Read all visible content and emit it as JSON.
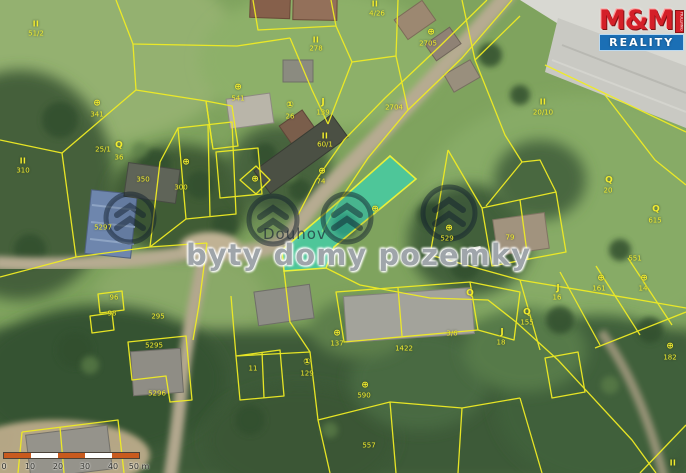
{
  "map": {
    "village_name": "Douhov",
    "watermark": "byty domy pozemky",
    "logo": {
      "mm": "M&M",
      "side": "HOLDING",
      "reality": "REALITY"
    },
    "colors": {
      "parcel_line": "#f0ec24",
      "highlight_fill": "rgba(38,228,202,0.55)",
      "highlight_stroke": "#e9f03a",
      "logo_red": "#d42028",
      "logo_blue": "#1b6fb5",
      "scale_orange": "#c85a1e",
      "scale_white": "#ffffff"
    },
    "scale_bar": {
      "segment_colors": [
        "#c85a1e",
        "#ffffff",
        "#c85a1e",
        "#ffffff",
        "#c85a1e"
      ],
      "labels": [
        {
          "x": 1,
          "t": "0"
        },
        {
          "x": 27,
          "t": "10"
        },
        {
          "x": 55,
          "t": "20"
        },
        {
          "x": 82,
          "t": "30"
        },
        {
          "x": 110,
          "t": "40"
        },
        {
          "x": 136,
          "t": "50 m"
        }
      ]
    },
    "parcel_labels": [
      {
        "x": 36,
        "y": 24,
        "t": "II",
        "k": "roman"
      },
      {
        "x": 36,
        "y": 34,
        "t": "51/2",
        "k": "num"
      },
      {
        "x": 97,
        "y": 104,
        "t": "⊕",
        "k": "sym"
      },
      {
        "x": 97,
        "y": 115,
        "t": "341",
        "k": "num"
      },
      {
        "x": 23,
        "y": 161,
        "t": "II",
        "k": "roman"
      },
      {
        "x": 23,
        "y": 171,
        "t": "310",
        "k": "num"
      },
      {
        "x": 103,
        "y": 150,
        "t": "25/1",
        "k": "num"
      },
      {
        "x": 119,
        "y": 146,
        "t": "Q",
        "k": "sym"
      },
      {
        "x": 119,
        "y": 158,
        "t": "36",
        "k": "num"
      },
      {
        "x": 143,
        "y": 180,
        "t": "350",
        "k": "num"
      },
      {
        "x": 181,
        "y": 188,
        "t": "300",
        "k": "num"
      },
      {
        "x": 186,
        "y": 163,
        "t": "⊕",
        "k": "sym"
      },
      {
        "x": 103,
        "y": 228,
        "t": "5297",
        "k": "num"
      },
      {
        "x": 158,
        "y": 317,
        "t": "295",
        "k": "num"
      },
      {
        "x": 154,
        "y": 346,
        "t": "5295",
        "k": "num"
      },
      {
        "x": 157,
        "y": 394,
        "t": "5296",
        "k": "num"
      },
      {
        "x": 114,
        "y": 298,
        "t": "96",
        "k": "num"
      },
      {
        "x": 112,
        "y": 314,
        "t": "98",
        "k": "num"
      },
      {
        "x": 316,
        "y": 40,
        "t": "II",
        "k": "roman"
      },
      {
        "x": 316,
        "y": 49,
        "t": "278",
        "k": "num"
      },
      {
        "x": 375,
        "y": 4,
        "t": "II",
        "k": "roman"
      },
      {
        "x": 377,
        "y": 14,
        "t": "4/26",
        "k": "num"
      },
      {
        "x": 238,
        "y": 88,
        "t": "⊕",
        "k": "sym"
      },
      {
        "x": 238,
        "y": 99,
        "t": "541",
        "k": "num"
      },
      {
        "x": 290,
        "y": 106,
        "t": "①",
        "k": "sym"
      },
      {
        "x": 290,
        "y": 117,
        "t": "26",
        "k": "num"
      },
      {
        "x": 323,
        "y": 103,
        "t": "J",
        "k": "sym"
      },
      {
        "x": 323,
        "y": 113,
        "t": "139",
        "k": "num"
      },
      {
        "x": 325,
        "y": 136,
        "t": "II",
        "k": "roman"
      },
      {
        "x": 325,
        "y": 145,
        "t": "60/1",
        "k": "num"
      },
      {
        "x": 394,
        "y": 108,
        "t": "2704",
        "k": "num"
      },
      {
        "x": 431,
        "y": 33,
        "t": "⊕",
        "k": "sym"
      },
      {
        "x": 428,
        "y": 44,
        "t": "2705",
        "k": "num"
      },
      {
        "x": 543,
        "y": 102,
        "t": "II",
        "k": "roman"
      },
      {
        "x": 543,
        "y": 113,
        "t": "20/10",
        "k": "num"
      },
      {
        "x": 322,
        "y": 172,
        "t": "⊕",
        "k": "sym"
      },
      {
        "x": 321,
        "y": 182,
        "t": "74",
        "k": "num"
      },
      {
        "x": 375,
        "y": 210,
        "t": "⊕",
        "k": "sym"
      },
      {
        "x": 449,
        "y": 229,
        "t": "⊕",
        "k": "sym"
      },
      {
        "x": 447,
        "y": 239,
        "t": "529",
        "k": "num"
      },
      {
        "x": 510,
        "y": 238,
        "t": "79",
        "k": "num"
      },
      {
        "x": 609,
        "y": 181,
        "t": "Q",
        "k": "sym"
      },
      {
        "x": 608,
        "y": 191,
        "t": "20",
        "k": "num"
      },
      {
        "x": 656,
        "y": 210,
        "t": "Q",
        "k": "sym"
      },
      {
        "x": 655,
        "y": 221,
        "t": "615",
        "k": "num"
      },
      {
        "x": 635,
        "y": 259,
        "t": "551",
        "k": "num"
      },
      {
        "x": 601,
        "y": 279,
        "t": "⊕",
        "k": "sym"
      },
      {
        "x": 599,
        "y": 289,
        "t": "161",
        "k": "num"
      },
      {
        "x": 644,
        "y": 279,
        "t": "⊕",
        "k": "sym"
      },
      {
        "x": 643,
        "y": 289,
        "t": "14",
        "k": "num"
      },
      {
        "x": 558,
        "y": 289,
        "t": "J",
        "k": "sym"
      },
      {
        "x": 557,
        "y": 298,
        "t": "16",
        "k": "num"
      },
      {
        "x": 470,
        "y": 294,
        "t": "Q",
        "k": "sym"
      },
      {
        "x": 527,
        "y": 313,
        "t": "Q",
        "k": "sym"
      },
      {
        "x": 527,
        "y": 323,
        "t": "155",
        "k": "num"
      },
      {
        "x": 502,
        "y": 333,
        "t": "J",
        "k": "sym"
      },
      {
        "x": 501,
        "y": 343,
        "t": "18",
        "k": "num"
      },
      {
        "x": 670,
        "y": 347,
        "t": "⊕",
        "k": "sym"
      },
      {
        "x": 670,
        "y": 358,
        "t": "182",
        "k": "num"
      },
      {
        "x": 673,
        "y": 463,
        "t": "II",
        "k": "roman"
      },
      {
        "x": 253,
        "y": 369,
        "t": "11",
        "k": "num"
      },
      {
        "x": 307,
        "y": 363,
        "t": "①",
        "k": "sym"
      },
      {
        "x": 307,
        "y": 374,
        "t": "129",
        "k": "num"
      },
      {
        "x": 337,
        "y": 334,
        "t": "⊕",
        "k": "sym"
      },
      {
        "x": 337,
        "y": 344,
        "t": "137",
        "k": "num"
      },
      {
        "x": 365,
        "y": 386,
        "t": "⊕",
        "k": "sym"
      },
      {
        "x": 364,
        "y": 396,
        "t": "590",
        "k": "num"
      },
      {
        "x": 404,
        "y": 349,
        "t": "1422",
        "k": "num"
      },
      {
        "x": 452,
        "y": 334,
        "t": "3/6",
        "k": "num"
      },
      {
        "x": 369,
        "y": 446,
        "t": "557",
        "k": "num"
      },
      {
        "x": 255,
        "y": 180,
        "t": "⊕",
        "k": "sym"
      }
    ]
  }
}
